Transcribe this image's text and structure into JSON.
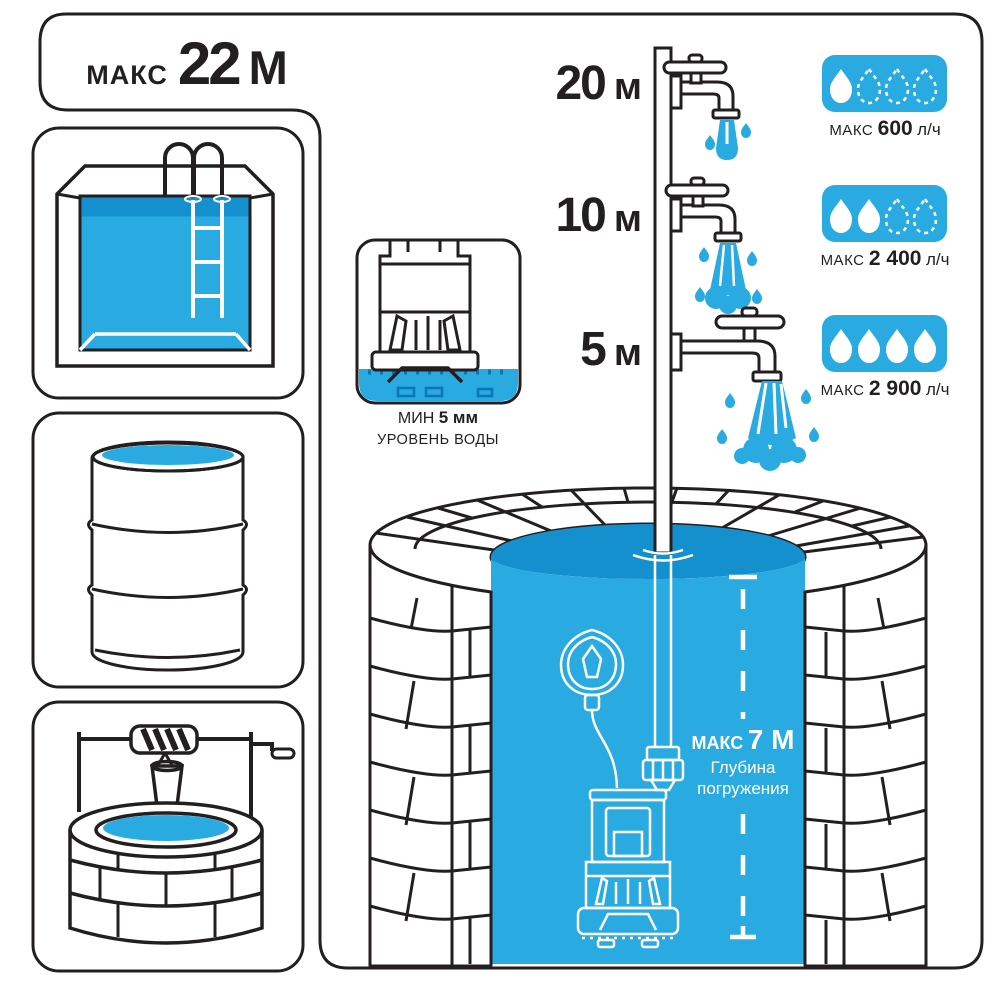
{
  "palette": {
    "accent_blue": "#29abe2",
    "accent_blue_dark": "#1590ce",
    "line_black": "#231f20",
    "text_white": "#ffffff"
  },
  "max_head": {
    "label": "МАКС",
    "value": "22",
    "unit": "М"
  },
  "source_icons": {
    "items": [
      "pool-icon",
      "barrel-icon",
      "well-icon"
    ]
  },
  "min_water_level": {
    "label": "МИН",
    "value": "5 мм",
    "caption": "УРОВЕНЬ ВОДЫ"
  },
  "outlets": [
    {
      "height": "20",
      "height_unit": "м",
      "flow_label": "МАКС",
      "flow_value": "600",
      "flow_unit": "л/ч",
      "drops_filled": 1,
      "drops_total": 4
    },
    {
      "height": "10",
      "height_unit": "м",
      "flow_label": "МАКС",
      "flow_value": "2 400",
      "flow_unit": "л/ч",
      "drops_filled": 2,
      "drops_total": 4
    },
    {
      "height": "5",
      "height_unit": "м",
      "flow_label": "МАКС",
      "flow_value": "2 900",
      "flow_unit": "л/ч",
      "drops_filled": 4,
      "drops_total": 4
    }
  ],
  "immersion": {
    "label": "МАКС",
    "value": "7 М",
    "caption_line1": "Глубина",
    "caption_line2": "погружения"
  }
}
